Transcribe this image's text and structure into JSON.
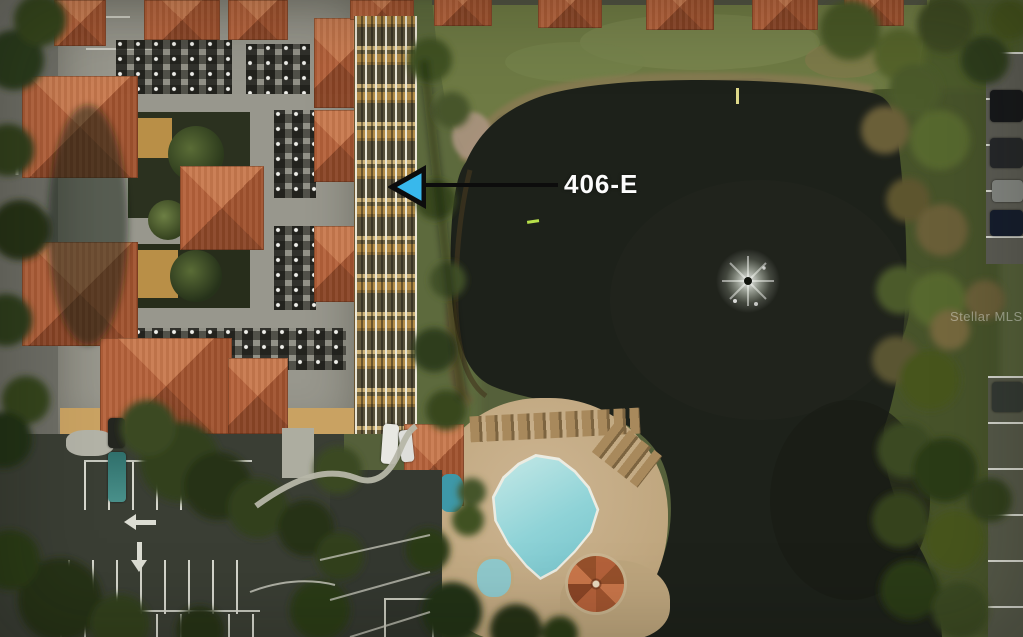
{
  "annotation": {
    "label": "406-E"
  },
  "watermark": {
    "text": "Stellar MLS"
  },
  "palette": {
    "water": "#1d211a",
    "grass": "#6e7a44",
    "roof_tile": "#b4613a",
    "flat_roof": "#98978d",
    "balcony_tan": "#a8813f",
    "pool_water": "#8fd3d7",
    "pool_deck": "#c3ab85",
    "asphalt": "#3a3e34",
    "road": "#6d6d65",
    "paint_line": "#d9dad0",
    "arrow_fill": "#38b8ec",
    "arrow_line": "#0c0c0c",
    "label_text": "#fcfcfc"
  }
}
